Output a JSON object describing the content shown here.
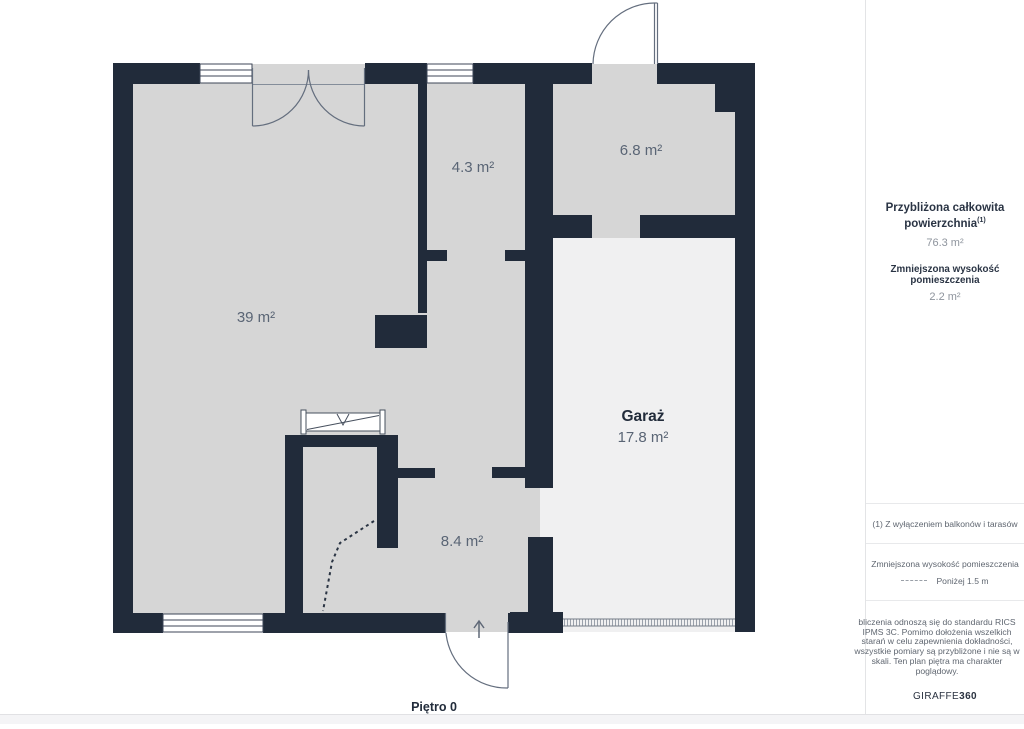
{
  "floor_plan": {
    "floor_label": "Piętro 0",
    "rooms": [
      {
        "area": "39 m²"
      },
      {
        "area": "4.3 m²"
      },
      {
        "area": "6.8 m²"
      },
      {
        "name": "Garaż",
        "area": "17.8 m²"
      },
      {
        "area": "8.4 m²"
      }
    ],
    "icons": {
      "entrance_direction": "arrow-up",
      "stairs": "staircase-symbol",
      "garage_door": "hatched-strip",
      "reduced_height_boundary": "dashed-line"
    }
  },
  "sidebar": {
    "summary": {
      "title": "Przybliżona całkowita powierzchnia",
      "title_sup": "(1)",
      "total_area": "76.3 m²",
      "reduced_height_label": "Zmniejszona wysokość pomieszczenia",
      "reduced_height_value": "2.2 m²"
    },
    "footnote": "(1) Z wyłączeniem balkonów i tarasów",
    "legend": {
      "title": "Zmniejszona wysokość pomieszczenia",
      "item_label": "Poniżej 1.5 m"
    },
    "disclaimer": "bliczenia odnoszą się do standardu RICS IPMS 3C. Pomimo dołożenia wszelkich starań w celu zapewnienia dokładności, wszystkie pomiary są przybliżone i nie są w skali. Ten plan piętra ma charakter poglądowy.",
    "brand": {
      "name": "GIRAFFE",
      "suffix": "360"
    }
  },
  "colors": {
    "wall": "#212b3a",
    "floor": "#d6d6d6",
    "garage_floor": "#f0f0f1",
    "heading_text": "#2a3444",
    "muted_text": "#8e949d",
    "label_text": "#5a6575"
  }
}
